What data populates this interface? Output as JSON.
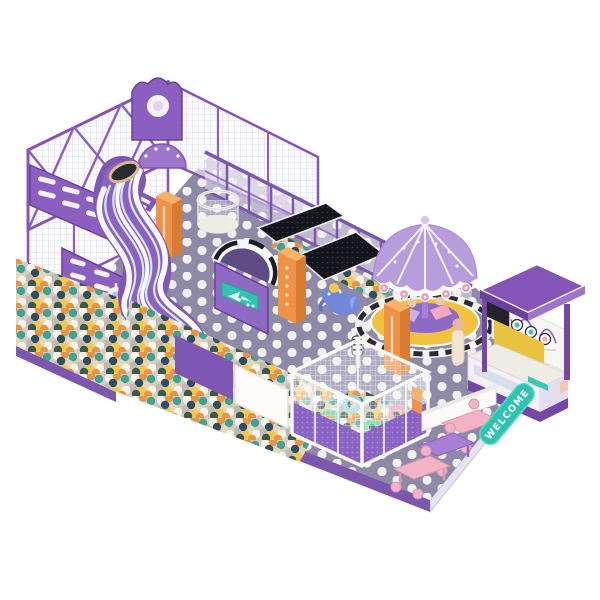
{
  "meta": {
    "type": "isometric-3d-render",
    "subject": "indoor soft-play playground, purple theme, on white background"
  },
  "labels": {
    "welcome_mat": "WELCOME"
  },
  "palette": {
    "floor": "#8d89a6",
    "floor_dots": "#f2f0ed",
    "frame_purple": "#8455b8",
    "dark_purple": "#6a3f9e",
    "light_purple": "#b79ddc",
    "slide_purple": "#7e57b5",
    "orange_pillar": "#ef9245",
    "teal_accent": "#2ec4b0",
    "platform_yellow": "#f0c23f",
    "table_pink": "#f3b3c7",
    "table_purple": "#a77fd6",
    "stripe_black": "#1d1d24",
    "ball_colors": [
      "#f6f3ec",
      "#e8d6b4",
      "#e9953f",
      "#3fa394",
      "#2f4f5e",
      "#3a5a4c",
      "#c0bab2",
      "#f2c84b"
    ]
  },
  "elements": [
    "net-climbing-structure",
    "wavy-slide",
    "ball-pit",
    "striped-tunnel",
    "trampoline-panels",
    "toddler-ball-cage",
    "carousel",
    "snack-kiosk",
    "dining-tables",
    "welcome-mat",
    "polka-dot-floor",
    "elephant-toy",
    "orange-pillars",
    "mesh-fence"
  ]
}
